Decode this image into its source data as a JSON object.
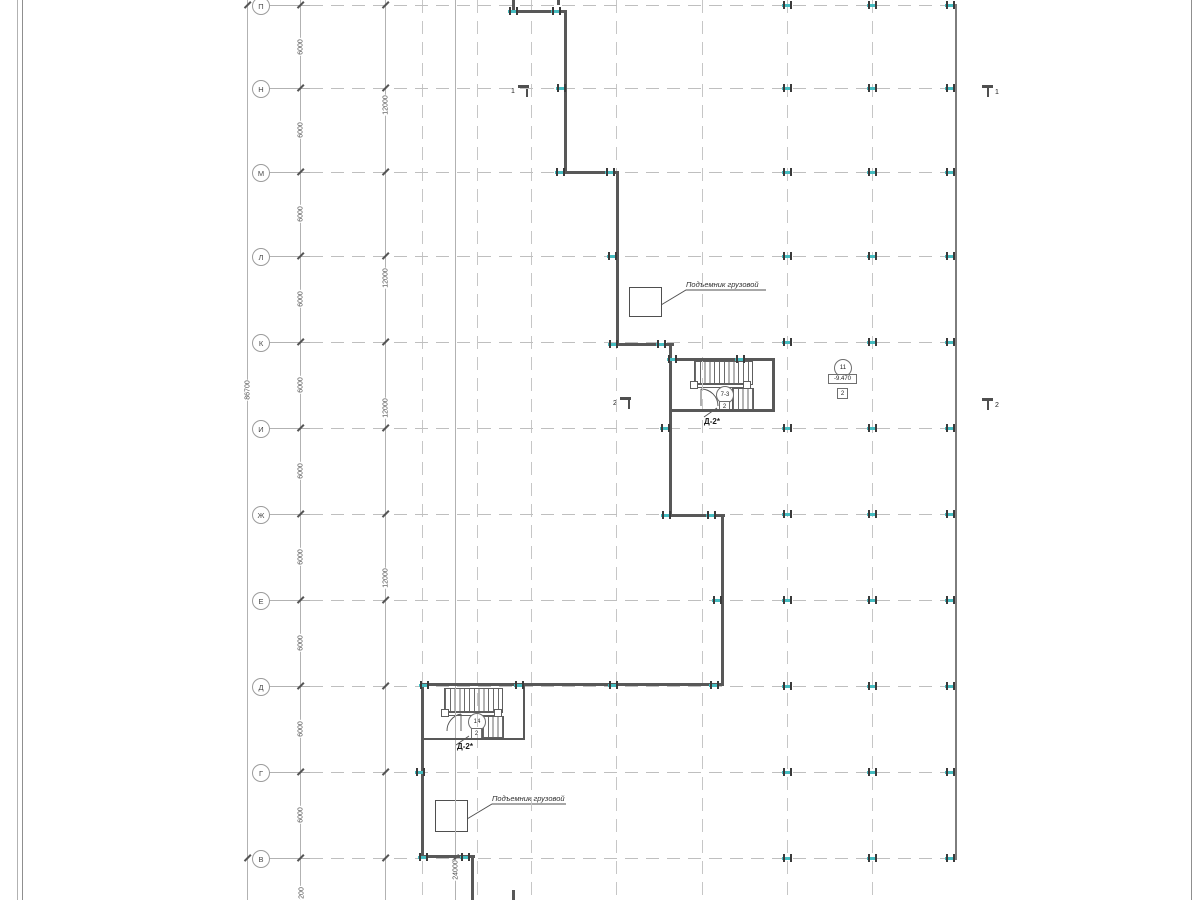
{
  "drawing": {
    "axis_letters": [
      "П",
      "Н",
      "М",
      "Л",
      "К",
      "И",
      "Ж",
      "Е",
      "Д",
      "Г",
      "В"
    ],
    "dim_6000": "6000",
    "dim_12000": "12000",
    "dim_total": "86700",
    "dim_24000": "24000",
    "dim_partial": "200",
    "hoist_label_upper": "Подъемник грузовой",
    "hoist_label_lower": "Подъемник грузовой",
    "stair_label_upper": "Д-2*",
    "stair_label_lower": "Д-2*",
    "stair_circle_upper": "7-3",
    "stair_square_upper": "2",
    "stair_circle_lower": "14",
    "stair_square_lower": "2",
    "column_circle": "11",
    "column_elevation": "-9.470",
    "column_square": "2",
    "section_1_left": "1",
    "section_1_right": "1",
    "section_2_left": "2",
    "section_2_right": "2"
  },
  "colors": {
    "wall": "#585858",
    "grid": "#bfbfbf",
    "teal": "#45bcc0",
    "text": "#4a4a4a"
  }
}
